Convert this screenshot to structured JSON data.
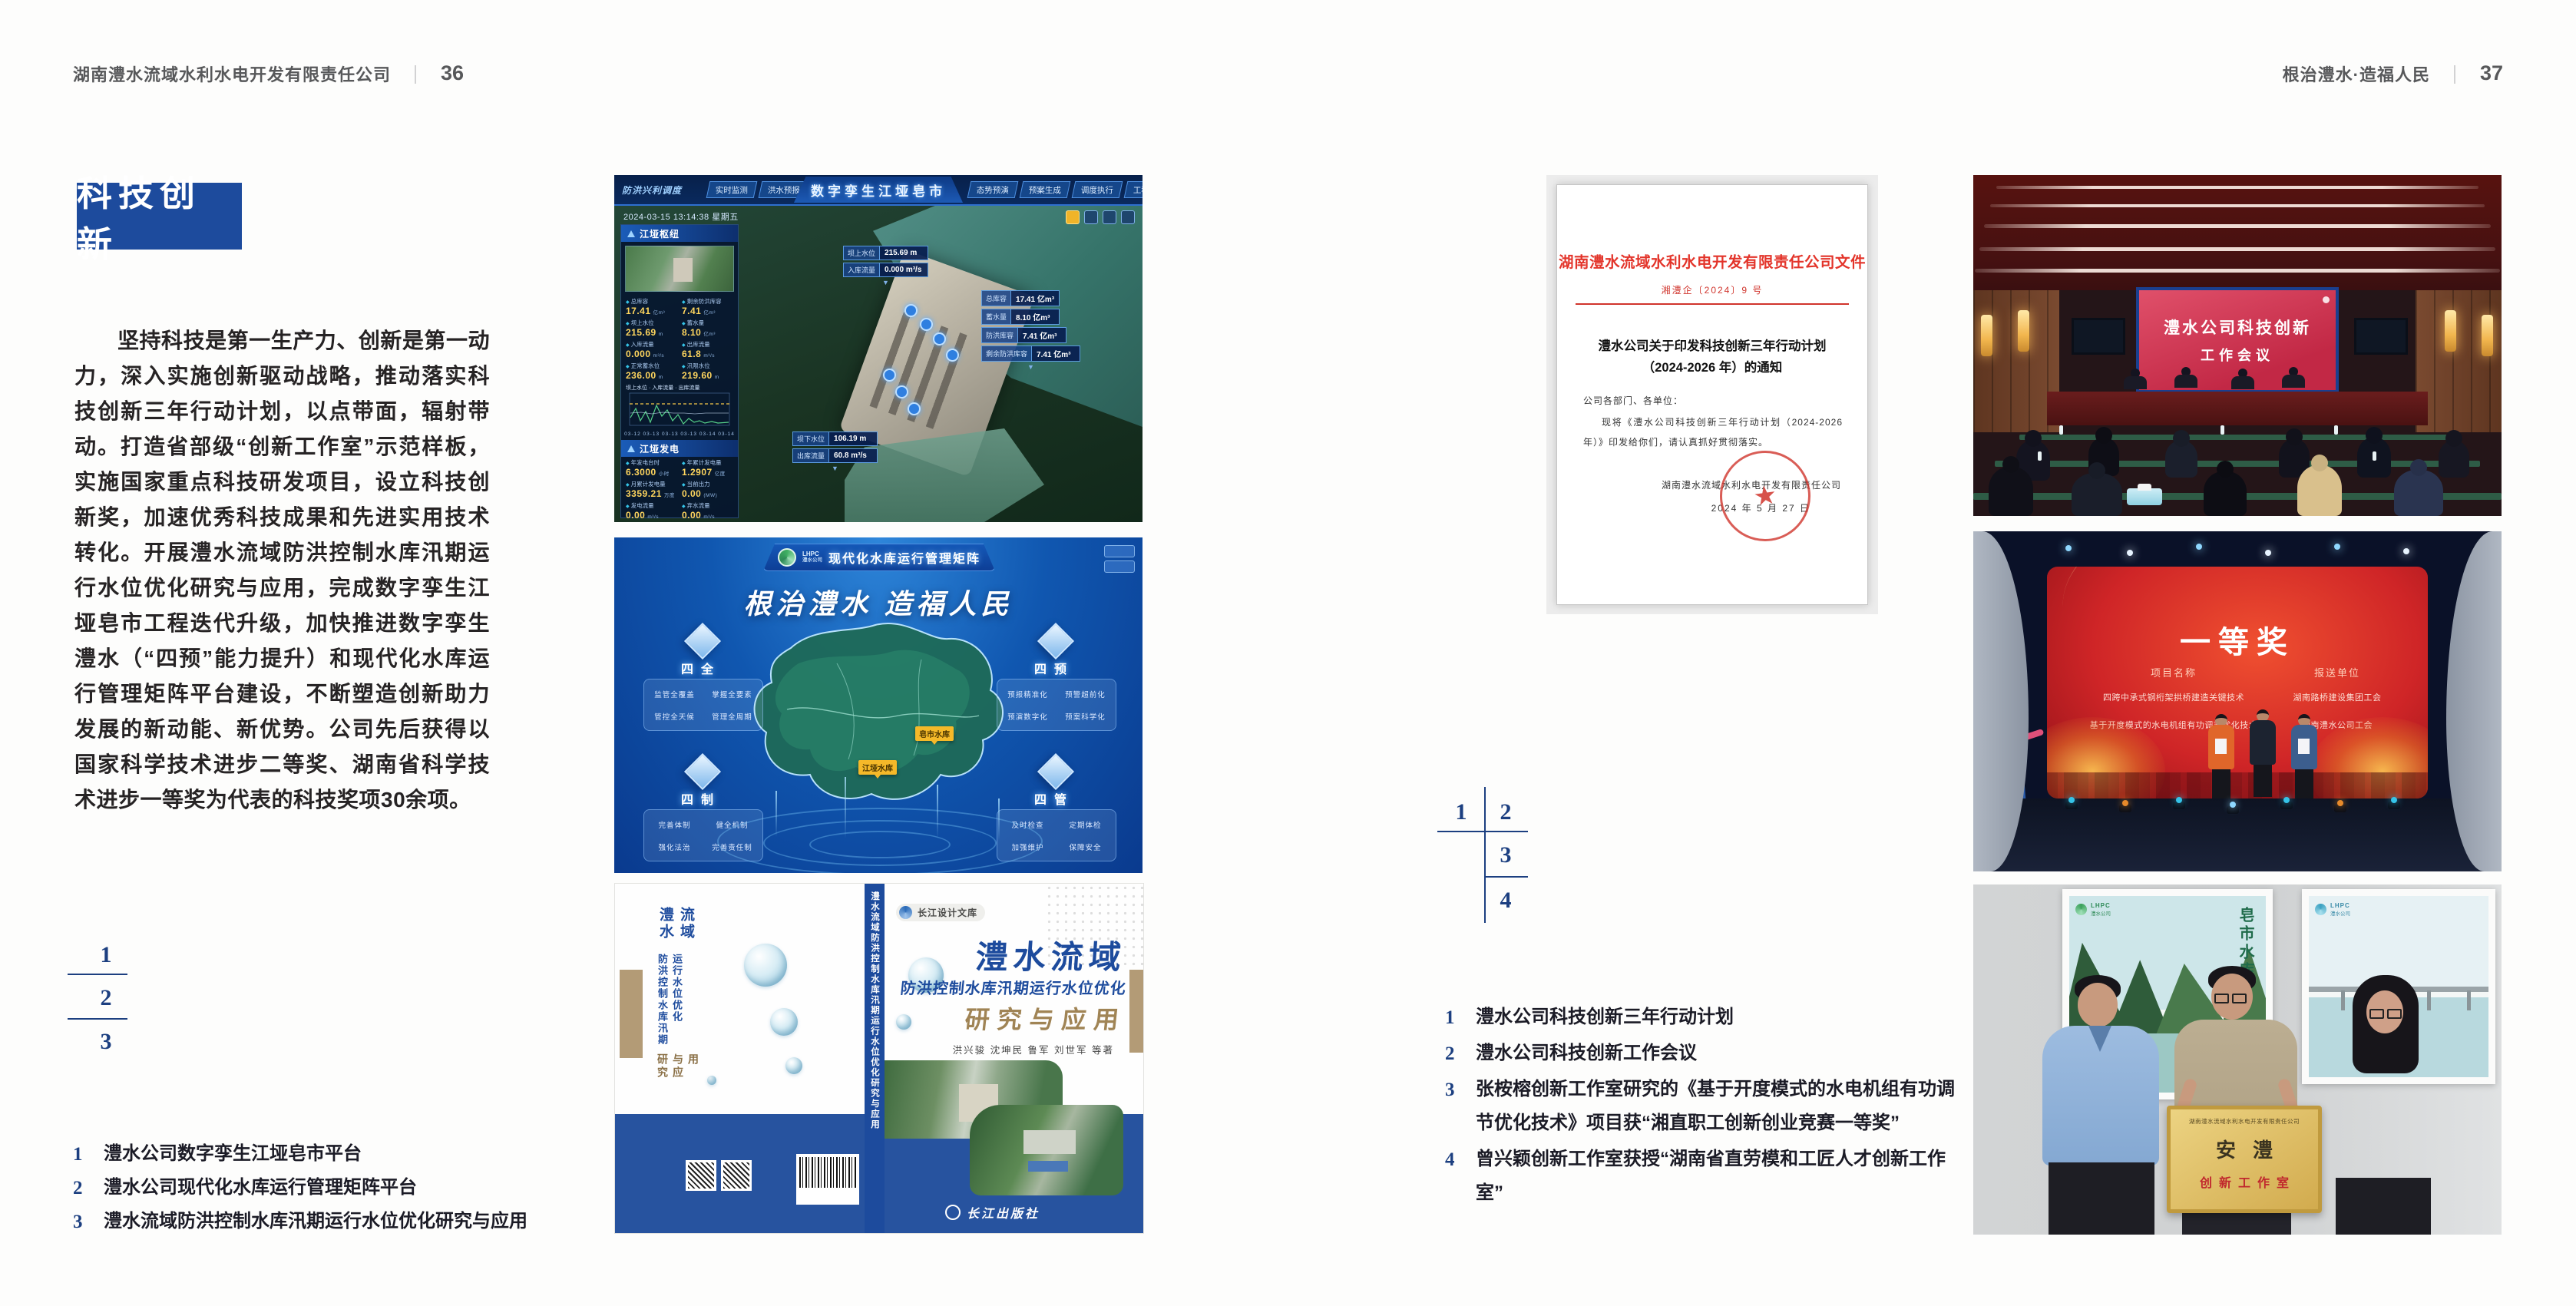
{
  "spread": {
    "header_left": {
      "company": "湖南澧水流域水利水电开发有限责任公司",
      "divider": "｜",
      "page": "36"
    },
    "header_right": {
      "slogan": "根治澧水·造福人民",
      "divider": "｜",
      "page": "37"
    },
    "section_title": "科技创新",
    "paragraph": "坚持科技是第一生产力、创新是第一动力，深入实施创新驱动战略，推动落实科技创新三年行动计划，以点带面，辐射带动。打造省部级“创新工作室”示范样板，实施国家重点科技研发项目，设立科技创新奖，加速优秀科技成果和先进实用技术转化。开展澧水流域防洪控制水库汛期运行水位优化研究与应用，完成数字孪生江垭皂市工程迭代升级，加快推进数字孪生澧水（“四预”能力提升）和现代化水库运行管理矩阵平台建设，不断塑造创新助力发展的新动能、新优势。公司先后获得以国家科学技术进步二等奖、湖南省科学技术进步一等奖为代表的科技奖项30余项。",
    "left_index": [
      "1",
      "2",
      "3"
    ],
    "right_index": [
      "1",
      "2",
      "3",
      "4"
    ],
    "left_captions": [
      {
        "num": "1",
        "text": "澧水公司数字孪生江垭皂市平台"
      },
      {
        "num": "2",
        "text": "澧水公司现代化水库运行管理矩阵平台"
      },
      {
        "num": "3",
        "text": "澧水流域防洪控制水库汛期运行水位优化研究与应用"
      }
    ],
    "right_captions": [
      {
        "num": "1",
        "text": "澧水公司科技创新三年行动计划"
      },
      {
        "num": "2",
        "text": "澧水公司科技创新工作会议"
      },
      {
        "num": "3",
        "text": "张桉榕创新工作室研究的《基于开度模式的水电机组有功调节优化技术》项目获“湘直职工创新创业竞赛一等奖”"
      },
      {
        "num": "4",
        "text": "曾兴颖创新工作室获授“湖南省直劳模和工匠人才创新工作室”"
      }
    ],
    "accent_blue": "#1d4b9d",
    "index_blue": "#1c3f80"
  },
  "digital_twin": {
    "corner_label": "防洪兴利调度",
    "tabs_left": [
      "实时监测",
      "洪水预报",
      "防洪预警"
    ],
    "title": "数字孪生江垭皂市",
    "tabs_right": [
      "态势预演",
      "预案生成",
      "调度执行",
      "工程管理"
    ],
    "datetime": "2024-03-15 13:14:38 星期五",
    "panel1_title": "江垭枢纽",
    "stats1": [
      {
        "label": "总库容",
        "value": "17.41",
        "unit": "亿m³"
      },
      {
        "label": "剩余防洪库容",
        "value": "7.41",
        "unit": "亿m³"
      },
      {
        "label": "坝上水位",
        "value": "215.69",
        "unit": "m"
      },
      {
        "label": "蓄水量",
        "value": "8.10",
        "unit": "亿m³"
      },
      {
        "label": "入库流量",
        "value": "0.000",
        "unit": "m³/s"
      },
      {
        "label": "出库流量",
        "value": "61.8",
        "unit": "m³/s"
      },
      {
        "label": "正常蓄水位",
        "value": "236.00",
        "unit": "m"
      },
      {
        "label": "汛限水位",
        "value": "219.60",
        "unit": "m"
      }
    ],
    "chart_legend": "坝上水位 · 入库流量 · 出库流量",
    "chart_x": "03-12  03-13  03-13  03-13  03-14  03-14",
    "panel2_title": "江垭发电",
    "stats2": [
      {
        "label": "年发电台时",
        "value": "6.3000",
        "unit": "小时"
      },
      {
        "label": "年累计发电量",
        "value": "1.2907",
        "unit": "亿度"
      },
      {
        "label": "月累计发电量",
        "value": "3359.21",
        "unit": "万度"
      },
      {
        "label": "当前出力",
        "value": "0.00",
        "unit": "(MW)"
      },
      {
        "label": "发电流量",
        "value": "0.00",
        "unit": "m³/s"
      },
      {
        "label": "弃水流量",
        "value": "0.00",
        "unit": "m³/s"
      }
    ],
    "gauges": [
      {
        "value": "0.00",
        "label": "1号机组"
      },
      {
        "value": "100.98",
        "label": "2号机组"
      },
      {
        "value": "0.00",
        "label": "3号机组"
      }
    ],
    "callout_a": [
      {
        "label": "坝上水位",
        "value": "215.69 m"
      },
      {
        "label": "入库流量",
        "value": "0.000 m³/s"
      }
    ],
    "callout_b": [
      {
        "label": "总库容",
        "value": "17.41 亿m³"
      },
      {
        "label": "蓄水量",
        "value": "8.10 亿m³"
      },
      {
        "label": "防洪库容",
        "value": "7.41 亿m³"
      },
      {
        "label": "剩余防洪库容",
        "value": "7.41 亿m³"
      }
    ],
    "callout_c": [
      {
        "label": "坝下水位",
        "value": "106.19 m"
      },
      {
        "label": "出库流量",
        "value": "60.8 m³/s"
      }
    ]
  },
  "matrix": {
    "logo_abbr": "LHPC",
    "logo_name": "澧水公司",
    "title": "现代化水库运行管理矩阵",
    "slogan": "根治澧水 造福人民",
    "quadrants": [
      {
        "name": "四全",
        "items": [
          "监管全覆盖",
          "掌握全要素",
          "管控全天候",
          "管理全周期"
        ]
      },
      {
        "name": "四预",
        "items": [
          "预报精准化",
          "预警超前化",
          "预演数字化",
          "预案科学化"
        ]
      },
      {
        "name": "四制",
        "items": [
          "完善体制",
          "健全机制",
          "强化法治",
          "完善责任制"
        ]
      },
      {
        "name": "四管",
        "items": [
          "及时检查",
          "定期体检",
          "加强维护",
          "保障安全"
        ]
      }
    ],
    "markers": [
      "皂市水库",
      "江垭水库"
    ]
  },
  "book": {
    "series": "长江设计文库",
    "title1": "澧水流域",
    "title2": "防洪控制水库汛期运行水位优化",
    "title3": "研究与应用",
    "authors": "洪兴骏 沈坤民 鲁军 刘世军 等著",
    "publisher": "长江出版社",
    "spine": "澧水流域防洪控制水库汛期运行水位优化研究与应用"
  },
  "document": {
    "header": "湖南澧水流域水利水电开发有限责任公司文件",
    "number": "湘澧企〔2024〕9 号",
    "title_1": "澧水公司关于印发科技创新三年行动计划",
    "title_2": "（2024-2026 年）的通知",
    "salutation": "公司各部门、各单位：",
    "body": "现将《澧水公司科技创新三年行动计划（2024-2026 年）》印发给你们，请认真抓好贯彻落实。",
    "signer": "湖南澧水流域水利水电开发有限责任公司",
    "date": "2024 年 5 月 27 日",
    "seal_star": "★"
  },
  "meeting": {
    "screen_line1": "澧水公司科技创新",
    "screen_line2": "工作会议"
  },
  "award": {
    "title": "一等奖",
    "col_project": "项目名称",
    "col_unit": "报送单位",
    "rows": [
      {
        "project": "四跨中承式钢桁架拱桥建造关键技术",
        "unit": "湖南路桥建设集团工会"
      },
      {
        "project": "基于开度模式的水电机组有功调节优化技术",
        "unit": "湖南澧水公司工会"
      }
    ]
  },
  "plaque": {
    "board_header": "湖南澧水流域水利水电开发有限责任公司",
    "board_title": "安澧",
    "board_subtitle": "创新工作室",
    "poster_left_logo_abbr": "LHPC",
    "poster_left_logo_name": "澧水公司",
    "poster_left_caption": "皂市水库",
    "poster_right_logo_abbr": "LHPC",
    "poster_right_logo_name": "澧水公司"
  }
}
